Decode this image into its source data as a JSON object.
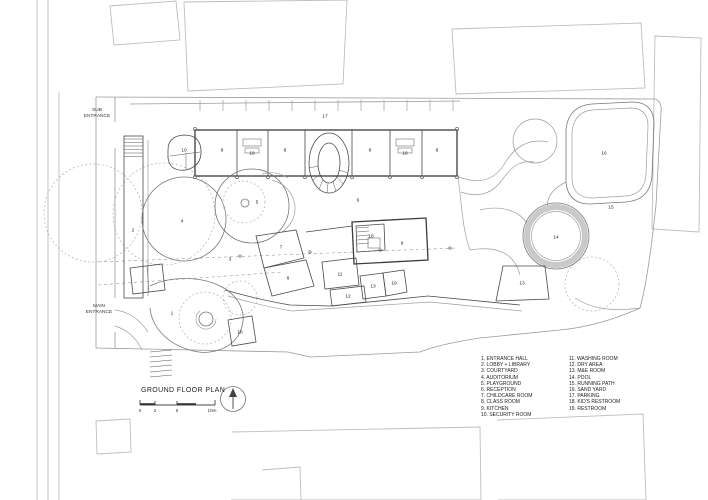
{
  "title": "GROUND FLOOR PLAN",
  "entrance_labels": {
    "sub": "SUB ENTRANCE",
    "main": "MAIN ENTRANCE"
  },
  "scale_bar": {
    "tick_labels": [
      "0",
      "2",
      "5",
      "10m"
    ]
  },
  "legend": {
    "column1": [
      "1. ENTRANCE HALL",
      "2. LOBBY + LIBRARY",
      "3. COURTYARD",
      "4. AUDITORIUM",
      "5. PLAYGROUND",
      "6. RECEPTION",
      "7. CHILDCARE ROOM",
      "8. CLASS ROOM",
      "9. KITCHEN",
      "10. SECURITY ROOM"
    ],
    "column2": [
      "11. WASHING ROOM",
      "12. DRY AREA",
      "13. M&E ROOM",
      "14. POOL",
      "15. RUNNING PATH",
      "16. SAND YARD",
      "17. PARKING",
      "18. KID'S RESTROOM",
      "19. RESTROOM"
    ]
  },
  "plan": {
    "room_labels": [
      {
        "n": "1",
        "x": 172,
        "y": 313
      },
      {
        "n": "2",
        "x": 133,
        "y": 230
      },
      {
        "n": "3",
        "x": 230,
        "y": 259
      },
      {
        "n": "4",
        "x": 182,
        "y": 221
      },
      {
        "n": "5",
        "x": 257,
        "y": 202
      },
      {
        "n": "6",
        "x": 358,
        "y": 200
      },
      {
        "n": "7",
        "x": 281,
        "y": 247
      },
      {
        "n": "8",
        "x": 222,
        "y": 150
      },
      {
        "n": "8",
        "x": 285,
        "y": 150
      },
      {
        "n": "8",
        "x": 370,
        "y": 150
      },
      {
        "n": "8",
        "x": 437,
        "y": 150
      },
      {
        "n": "8",
        "x": 288,
        "y": 278
      },
      {
        "n": "9",
        "x": 402,
        "y": 243
      },
      {
        "n": "10",
        "x": 184,
        "y": 150
      },
      {
        "n": "11",
        "x": 340,
        "y": 274
      },
      {
        "n": "12",
        "x": 348,
        "y": 296
      },
      {
        "n": "13",
        "x": 373,
        "y": 286
      },
      {
        "n": "13",
        "x": 522,
        "y": 283
      },
      {
        "n": "14",
        "x": 556,
        "y": 237
      },
      {
        "n": "15",
        "x": 611,
        "y": 207
      },
      {
        "n": "16",
        "x": 604,
        "y": 153
      },
      {
        "n": "17",
        "x": 325,
        "y": 116
      },
      {
        "n": "18",
        "x": 252,
        "y": 153
      },
      {
        "n": "18",
        "x": 405,
        "y": 153
      },
      {
        "n": "18",
        "x": 371,
        "y": 236
      },
      {
        "n": "18",
        "x": 240,
        "y": 332
      },
      {
        "n": "19",
        "x": 394,
        "y": 283
      }
    ]
  },
  "colors": {
    "wall": "#3b3b3b",
    "context": "#bdbdbd",
    "pool_ring": "#c9c9c9"
  }
}
